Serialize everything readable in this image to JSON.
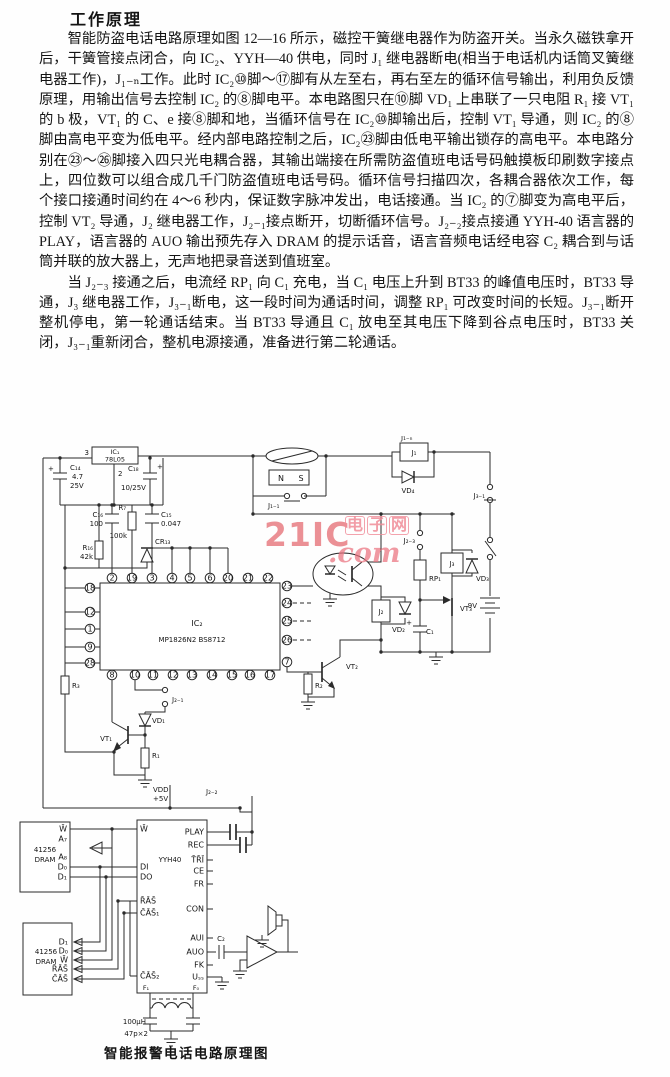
{
  "page": {
    "title": "工作原理",
    "caption": "智能报警电话电路原理图"
  },
  "paragraphs": [
    "智能防盗电话电路原理如图 12—16 所示，磁控干簧继电器作为防盗开关。当永久磁铁拿开后，干簧管接点闭合，向 IC₂、YYH—40 供电，同时 J₁ 继电器断电(相当于电话机内话筒叉簧继电器工作)，J₁₋ₙ工作。此时 IC₂⑩脚～⑰脚有从左至右，再右至左的循环信号输出，利用负反馈原理，用输出信号去控制 IC₂ 的⑧脚电平。本电路图只在⑩脚 VD₁ 上串联了一只电阻 R₁ 接 VT₁ 的 b 极，VT₁ 的 C、e 接⑧脚和地，当循环信号在 IC₂⑩脚输出后，控制 VT₁ 导通，则 IC₂ 的⑧脚由高电平变为低电平。经内部电路控制之后，IC₂㉓脚由低电平输出锁存的高电平。本电路分别在㉓～㉖脚接入四只光电耦合器，其输出端接在所需防盗值班电话号码触摸板印刷数字接点上，四位数可以组合成几千门防盗值班电话号码。循环信号扫描四次，各耦合器依次工作，每个接口接通时间约在 4～6 秒内，保证数字脉冲发出，电话接通。当 IC₂ 的⑦脚变为高电平后，控制 VT₂ 导通，J₂ 继电器工作，J₂₋₁接点断开，切断循环信号。J₂₋₂接点接通 YYH-40 语言器的 PLAY，语言器的 AUO 输出预先存入 DRAM 的提示话音，语言音频电话经电容 C₂ 耦合到与话筒并联的放大器上，无声地把录音送到值班室。",
    "当 J₂₋₃ 接通之后，电流经 RP₁ 向 C₁ 充电，当 C₁ 电压上升到 BT33 的峰值电压时，BT33 导通，J₃ 继电器工作，J₃₋₁断电，这一段时间为通话时间，调整 RP₁ 可改变时间的长短。J₃₋₁断开整机停电，第一轮通话结束。当 BT33 导通且 C₁ 放电至其电压下降到谷点电压时，BT33 关闭，J₃₋₁重新闭合，整机电源接通，准备进行第二轮通话。"
  ],
  "watermark": {
    "big": "21IC",
    "cn": "电子网",
    "com": ".com"
  },
  "schematic": {
    "ic1": {
      "name": "IC₁",
      "part": "78L05",
      "pin_left": "3",
      "pin_bottom": "2"
    },
    "c14": {
      "name": "C₁₄",
      "v1": "4.7",
      "v2": "25V",
      "plus": "+"
    },
    "c18": {
      "name": "C₁₈",
      "value": "10/25V",
      "plus": "+"
    },
    "c16": {
      "name": "C₁₆",
      "value": "100"
    },
    "r7": {
      "name": "R₇",
      "value": "100k"
    },
    "c15": {
      "name": "C₁₅",
      "value": "0.047"
    },
    "r16": {
      "name": "R₁₆",
      "value": "42k"
    },
    "cr13": "CR₁₃",
    "magnet": {
      "n": "N",
      "s": "S"
    },
    "contacts": {
      "j1_1": "J₁₋₁",
      "j3_1": "J₃₋₁",
      "j2_3": "J₂₋₃",
      "j2_1": "J₂₋₁",
      "j2_2": "J₂₋₂"
    },
    "relays": {
      "j1": "J₁",
      "j1n": "J₁₋ₙ",
      "j2": "J₂",
      "j3": "J₃"
    },
    "diodes": {
      "vd1": "VD₁",
      "vd2": "VD₂",
      "vd3": "VD₃",
      "vd4": "VD₄"
    },
    "battery": "9V",
    "rp1": "RP₁",
    "transistors": {
      "vt1": "VT₁",
      "vt2": "VT₂",
      "vt3": "VT₃"
    },
    "caps": {
      "c1": "C₁",
      "c1_plus": "+",
      "c2": "C₂"
    },
    "resistors": {
      "r1": "R₁",
      "r2": "R₂",
      "r3": "R₃"
    },
    "power": {
      "vdd": "VDD",
      "v5": "+5V"
    },
    "ic2": {
      "name": "IC₂",
      "part": "MP1826N2 BS8712",
      "pins_top": [
        "2",
        "19",
        "3",
        "4",
        "5",
        "6",
        "20",
        "21",
        "22"
      ],
      "pins_bottom": [
        "8",
        "10",
        "11",
        "12",
        "13",
        "14",
        "15",
        "16",
        "17"
      ],
      "pins_left": [
        "18",
        "12",
        "1",
        "9",
        "28"
      ],
      "pins_right": [
        "23",
        "24",
        "25",
        "26"
      ],
      "pin_corner": "7"
    },
    "yyh40": {
      "name": "YYH40",
      "left_pins": [
        "W̄",
        "DI",
        "DO",
        "R̄ĀS̄",
        "C̄ĀS̄₁",
        "C̄ĀS̄₂"
      ],
      "right_pins": [
        "PLAY",
        "REC",
        "T̄R̄Ī",
        "CE",
        "FR",
        "CON",
        "AUI",
        "AUO",
        "FK",
        "Uₛₛ"
      ],
      "f1": "F₁",
      "f0": "F₀"
    },
    "dram1": {
      "name": "41256",
      "type": "DRAM",
      "pins": [
        "W̄",
        "A₇",
        "A₈",
        "D₀",
        "D₁"
      ]
    },
    "dram2": {
      "name": "41256",
      "type": "DRAM",
      "pins": [
        "D₁",
        "D₀",
        "W̄",
        "R̄ĀS̄",
        "C̄ĀS̄"
      ]
    },
    "osc": {
      "l": "100μH",
      "c": "47p×2"
    }
  }
}
